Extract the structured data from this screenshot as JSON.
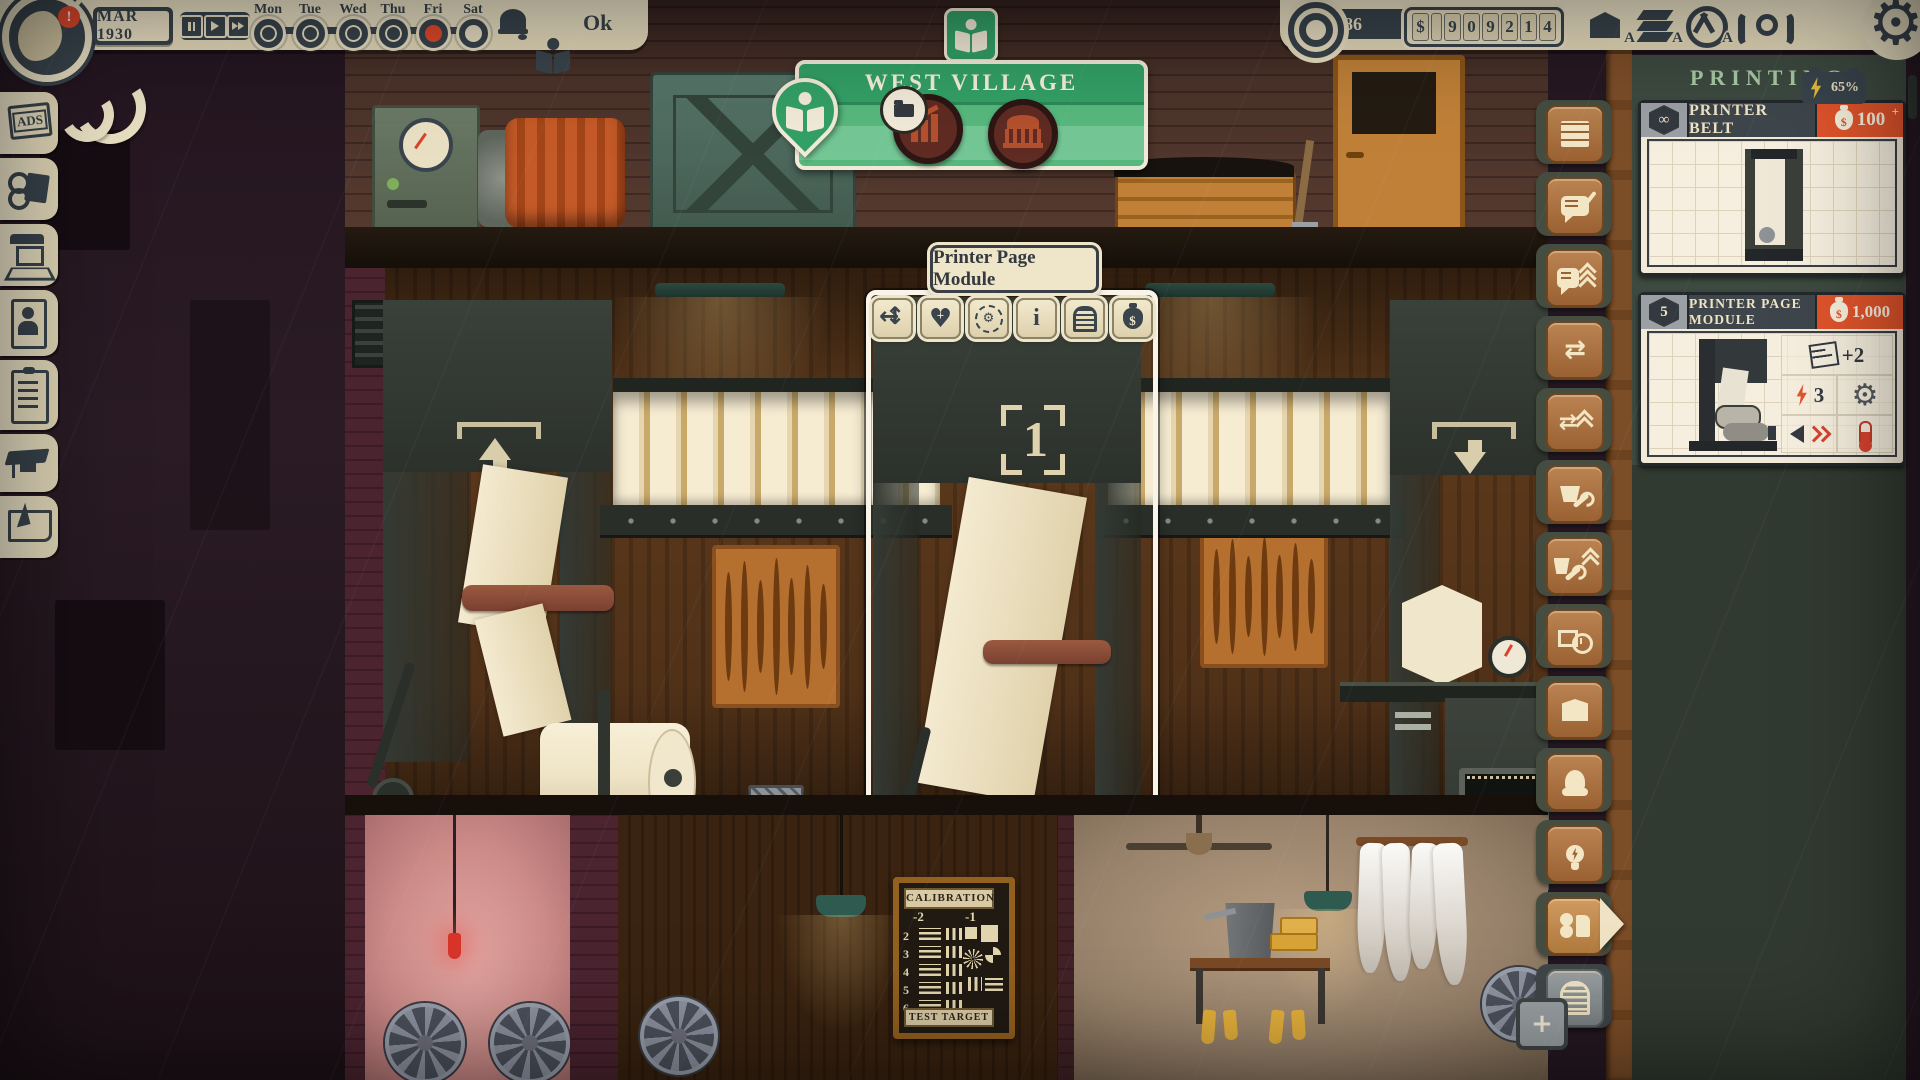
{
  "topbar": {
    "date": "MAR 1930",
    "ok": "Ok",
    "days": [
      {
        "label": "Mon",
        "state": "filled"
      },
      {
        "label": "Tue",
        "state": "filled"
      },
      {
        "label": "Wed",
        "state": "filled"
      },
      {
        "label": "Thu",
        "state": "filled"
      },
      {
        "label": "Fri",
        "state": "current"
      },
      {
        "label": "Sat",
        "state": "empty"
      }
    ]
  },
  "resources": {
    "reputation": "86",
    "money": [
      "$",
      "",
      "9",
      "0",
      "9",
      "2",
      "1",
      "4"
    ],
    "battery": "65%",
    "auto_badge": "A"
  },
  "location": {
    "name": "WEST VILLAGE"
  },
  "sidebar": {
    "ads": "ADS"
  },
  "tooltip": {
    "title": "Printer Page Module",
    "buttons": [
      "move",
      "repair",
      "auto-maintain",
      "info",
      "store",
      "sell"
    ]
  },
  "panel": {
    "title": "PRINTING",
    "cards": [
      {
        "badge": "∞",
        "title": "PRINTER BELT",
        "cost": "100",
        "plus": "+"
      },
      {
        "badge": "5",
        "title": "PRINTER PAGE MODULE",
        "cost": "1,000",
        "pages": "+2",
        "power": "3"
      }
    ]
  },
  "scene": {
    "machine_number": "1",
    "calibration": {
      "title": "CALIBRATION",
      "columns": [
        "-2",
        "-1"
      ],
      "rows": [
        "2",
        "3",
        "4",
        "5",
        "6"
      ],
      "footer": "TEST TARGET"
    }
  }
}
